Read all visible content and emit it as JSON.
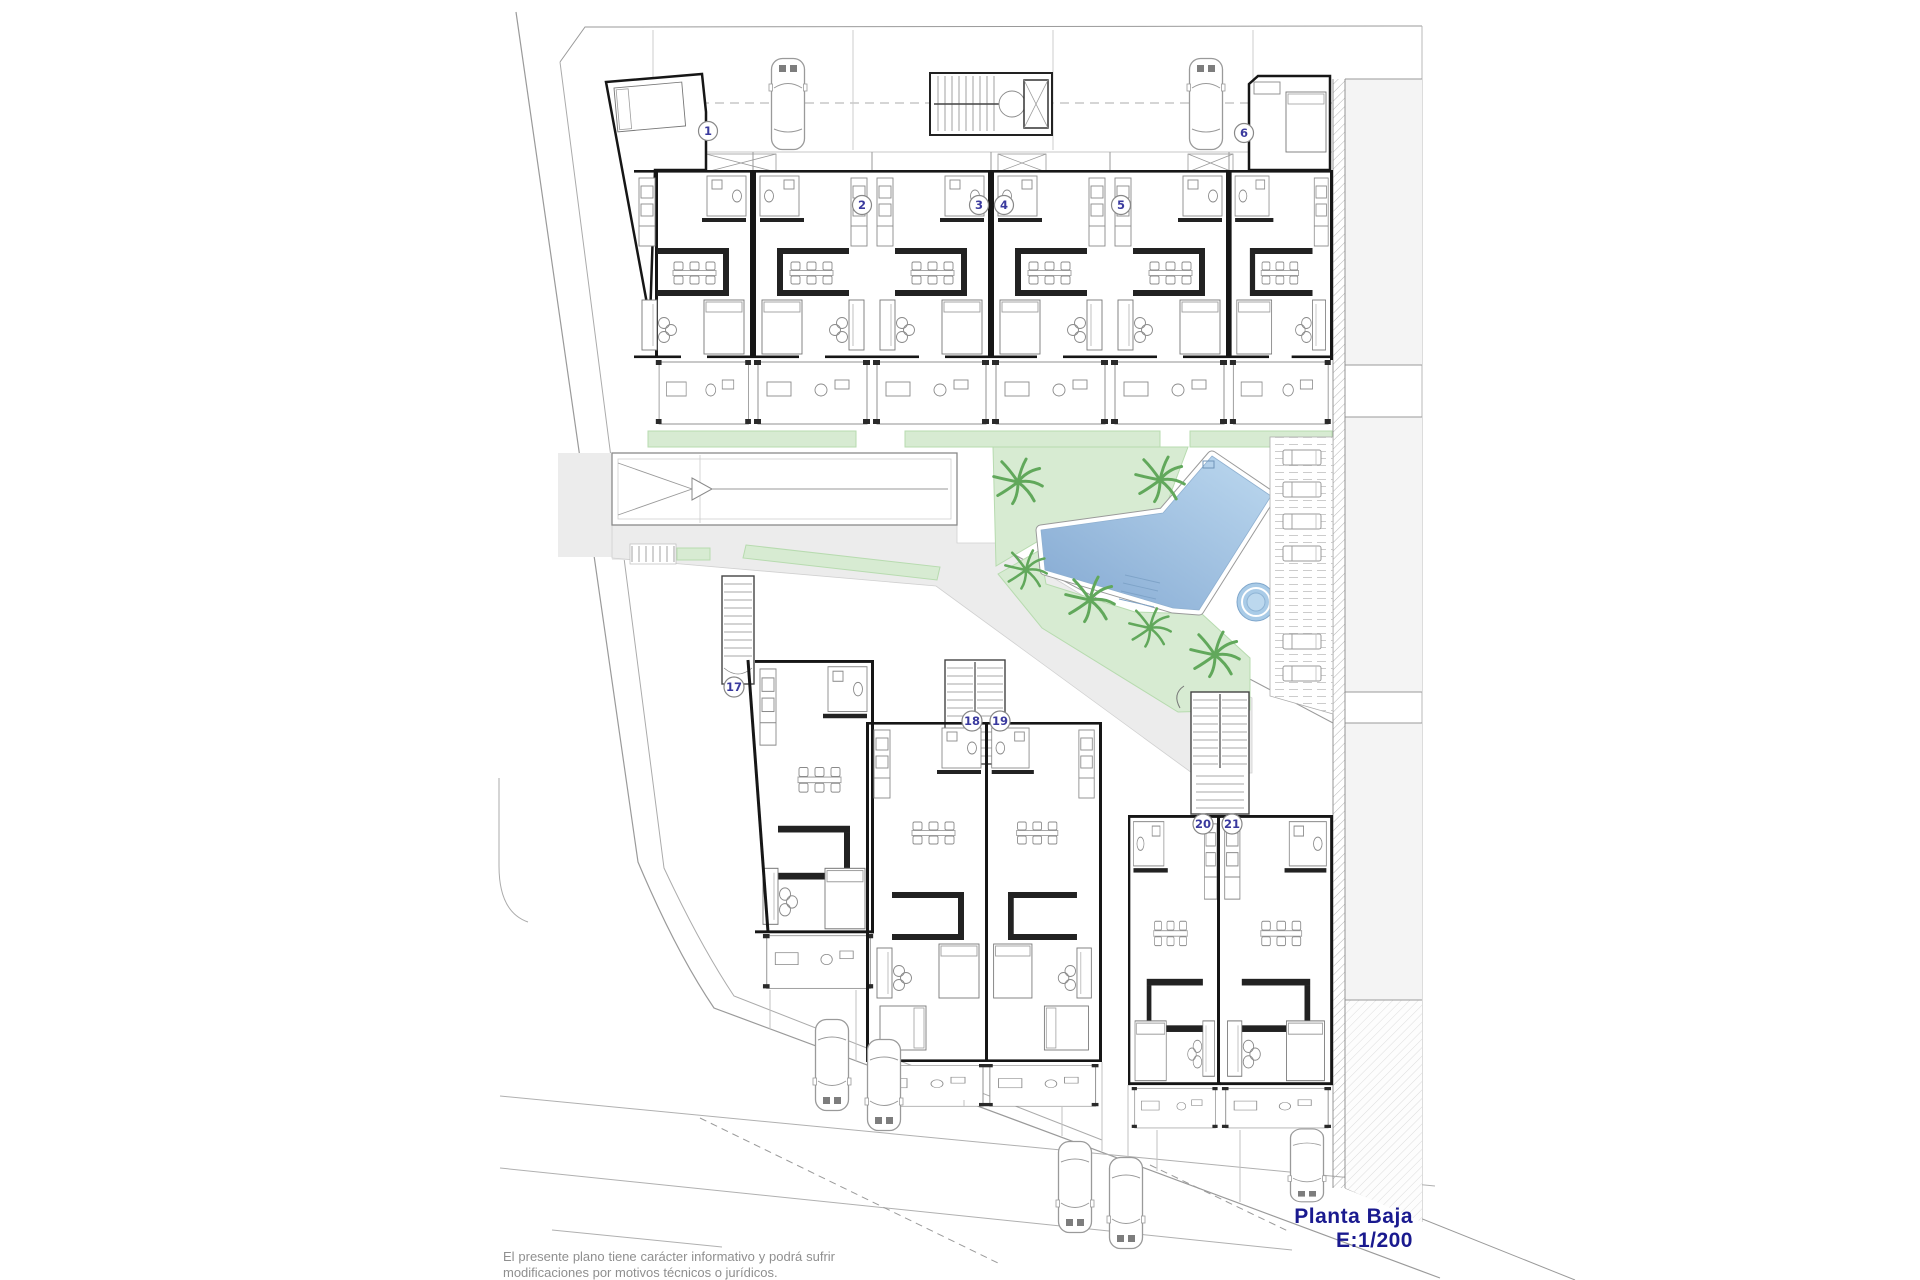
{
  "plan": {
    "title": "Planta Baja",
    "scale": "E:1/200",
    "disclaimer": {
      "line1": "El presente plano tiene carácter informativo y podrá sufrir",
      "line2": "modificaciones por motivos técnicos o jurídicos."
    },
    "unit_labels": {
      "u1": "1",
      "u2": "2",
      "u3": "3",
      "u4": "4",
      "u5": "5",
      "u6": "6",
      "u17": "17",
      "u18": "18",
      "u19": "19",
      "u20": "20",
      "u21": "21"
    },
    "rows": {
      "top_row_units": [
        "1",
        "2",
        "3",
        "4",
        "5",
        "6"
      ],
      "bottom_row_units": [
        "17",
        "18",
        "19",
        "20",
        "21"
      ]
    },
    "amenities": {
      "swimming_pool": 1,
      "spa_whirlpool": 1,
      "palm_trees": 6,
      "sun_loungers": 6,
      "staircases": 4,
      "elevator": 1,
      "parking_ramp_with_arrow": 1,
      "cars_parked_top": 2,
      "cars_parked_bottom": 5
    },
    "colors": {
      "pool_light": "#bcd8ef",
      "pool_dark": "#84a9d2",
      "spa_fill": "#a9cbe7",
      "garden": "#d7ebd2",
      "garden_edge": "#b7dbaf",
      "walkway": "#ececec",
      "road_band": "#f4f4f4",
      "wall": "#161616",
      "unit_label": "#3a3a9e",
      "title": "#1a1a8f",
      "disclaimer": "#8f8f8f"
    }
  }
}
